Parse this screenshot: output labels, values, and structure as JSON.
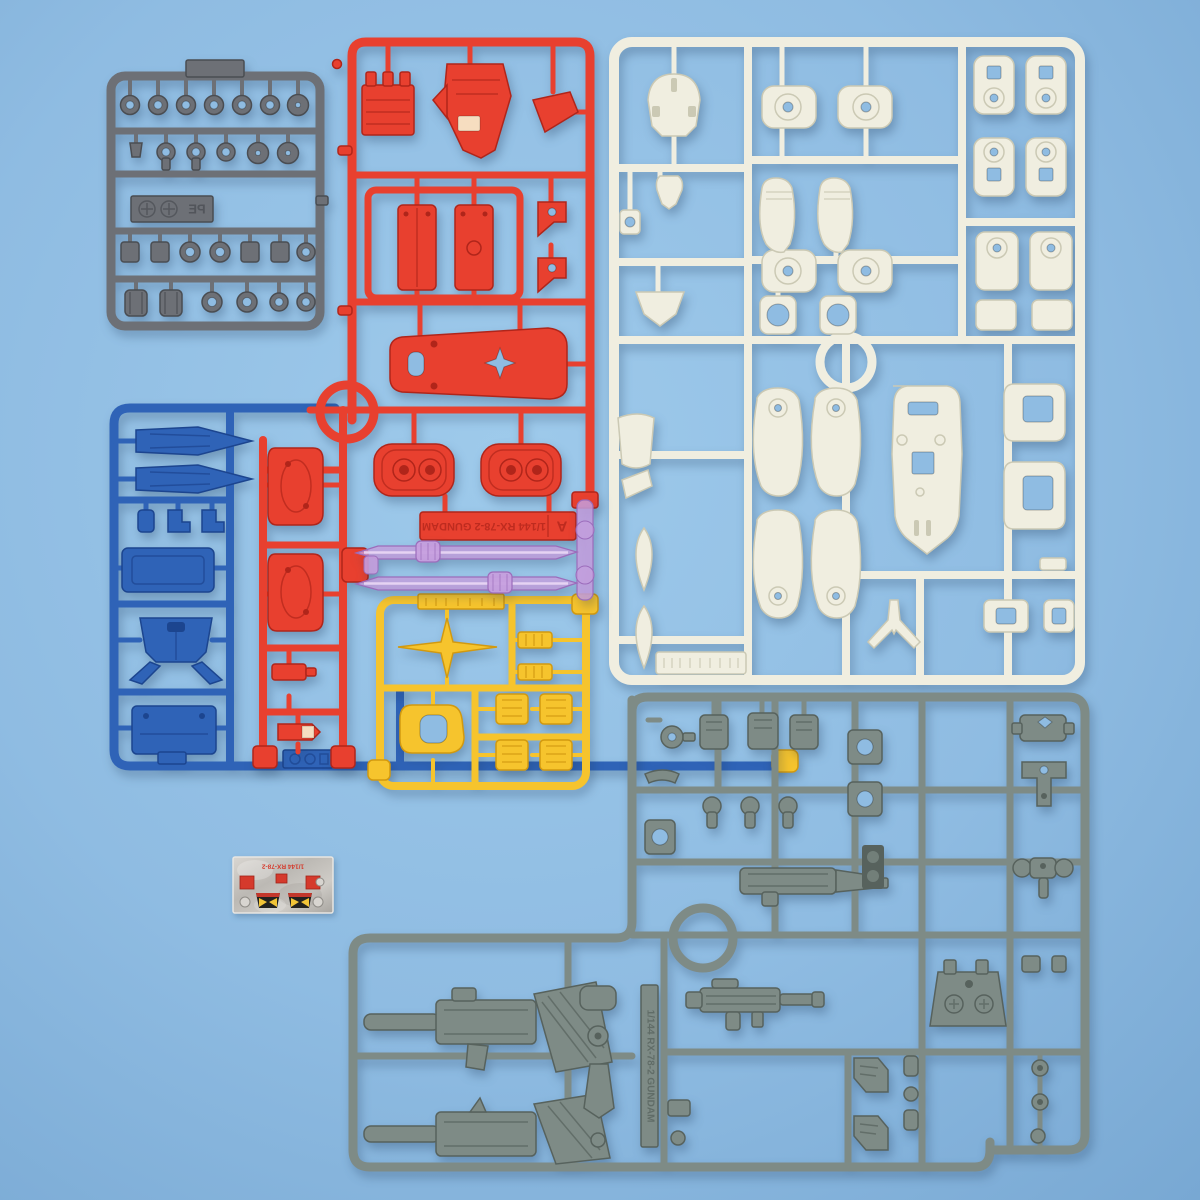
{
  "scene": {
    "description": "Photograph of plastic model kit part runners (sprues) for a 1/144 RX-78-2 Gundam kit laid out on a light blue surface",
    "kit_title": "1/144 RX-78-2 GUNDAM"
  },
  "colors": {
    "bg": "#8FBCE2",
    "bg_hl": "#9ECAEB",
    "bg_edge": "#78A8D3",
    "red": "#E8402F",
    "red_dk": "#B0251A",
    "red_hl": "#F4766B",
    "white": "#F0EEE0",
    "white_dk": "#CBC9B4",
    "blue": "#2F63B7",
    "blue_dk": "#1C458F",
    "yellow": "#F6C42D",
    "yellow_dk": "#D2990F",
    "polycap": "#6D7076",
    "polycap_dk": "#4A4D52",
    "gray": "#7E8B86",
    "gray_dk": "#57625D",
    "clear": "#C69FDE",
    "clear_dk": "#9B6CBB",
    "clear_hl": "#EBD8F5",
    "silver": "#C2BFBA",
    "silver_dk": "#8F8C87",
    "sticker_red": "#D53A2C",
    "sticker_black": "#23221F",
    "sticker_yellow": "#F2C437"
  },
  "runners": {
    "polycap": {
      "label": "PE",
      "color_name": "dark gray",
      "content": "polycap joint parts"
    },
    "red": {
      "tag_text": "1/144 RX-78-2 GUNDAM",
      "tag_letter": "A",
      "color_name": "red",
      "content": "chest, shield, foot soles, skirt armor"
    },
    "white": {
      "color_name": "ivory white",
      "content": "head, arms, legs, shield backing, feet"
    },
    "blue": {
      "color_name": "blue",
      "content": "torso, chest ducts, waist"
    },
    "yellow": {
      "color_name": "yellow",
      "content": "V-fin antenna, eye visor, vents"
    },
    "clear": {
      "color_name": "translucent pink",
      "content": "beam saber blades"
    },
    "gray": {
      "tag_text": "1/144 RX-78-2 GUNDAM",
      "color_name": "gray",
      "content": "beam rifles, machine gun, joints, backpack, hands"
    }
  },
  "sticker_sheet": {
    "header_text": "1/144 RX-78-2",
    "content": "metallic foil stickers: eyes and red sensors"
  }
}
